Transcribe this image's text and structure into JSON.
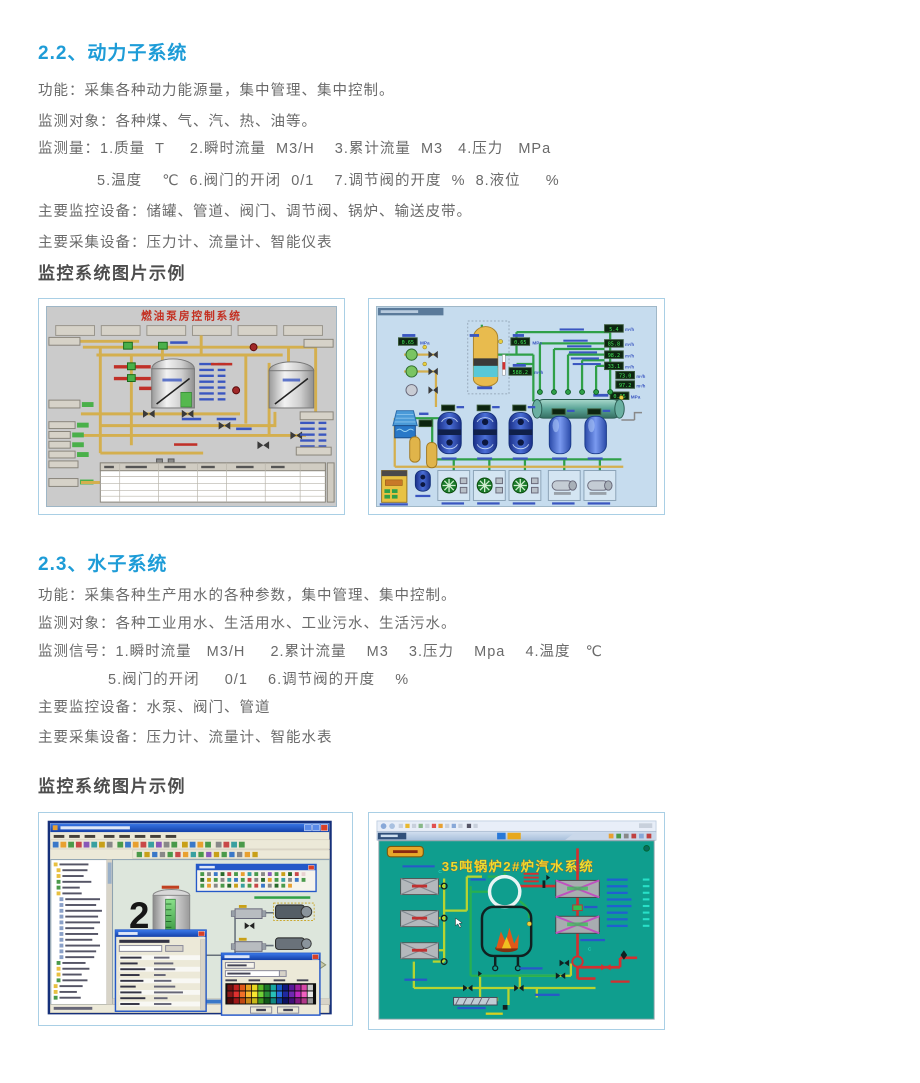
{
  "colors": {
    "heading_blue": "#1e9cd7",
    "body_text": "#6a6a6a",
    "subheading_gray": "#4d4d4d",
    "figure_border": "#a9cfe5"
  },
  "section_power": {
    "title": "2.2、动力子系统",
    "lines": [
      "功能：采集各种动力能源量，集中管理、集中控制。",
      "监测对象：各种煤、气、汽、热、油等。",
      "监测量：1.质量  T     2.瞬时流量  M3/H    3.累计流量  M3   4.压力   MPa",
      "5.温度    ℃  6.阀门的开闭  0/1    7.调节阀的开度  %  8.液位     %",
      "主要监控设备：储罐、管道、阀门、调节阀、锅炉、输送皮带。",
      "主要采集设备：压力计、流量计、智能仪表"
    ],
    "gallery_heading": "监控系统图片示例"
  },
  "section_water": {
    "title": "2.3、水子系统",
    "lines": [
      "功能：采集各种生产用水的各种参数，集中管理、集中控制。",
      "监测对象：各种工业用水、生活用水、工业污水、生活污水。",
      "监测信号：1.瞬时流量   M3/H     2.累计流量    M3    3.压力    Mpa    4.温度   ℃",
      "5.阀门的开闭     0/1    6.调节阀的开度    %",
      "主要监控设备：水泵、阀门、管道",
      "主要采集设备：压力计、流量计、智能水表"
    ],
    "gallery_heading": "监控系统图片示例"
  },
  "figures": {
    "fuel_pump": {
      "title": "燃油泵房控制系统"
    },
    "air_station": {
      "flow_readouts": [
        "5.4",
        "85.8",
        "98.2",
        "33.1",
        "73.0",
        "97.2"
      ],
      "flow_unit": "m³/h",
      "pressure_values": [
        "0.65",
        "0.65",
        "0.65"
      ],
      "pressure_unit": "MPa",
      "total_flow": "588.2"
    },
    "scada_editor": {
      "canvas_number": "2"
    },
    "boiler": {
      "page_title": "35吨锅炉2#炉汽水系统"
    }
  }
}
